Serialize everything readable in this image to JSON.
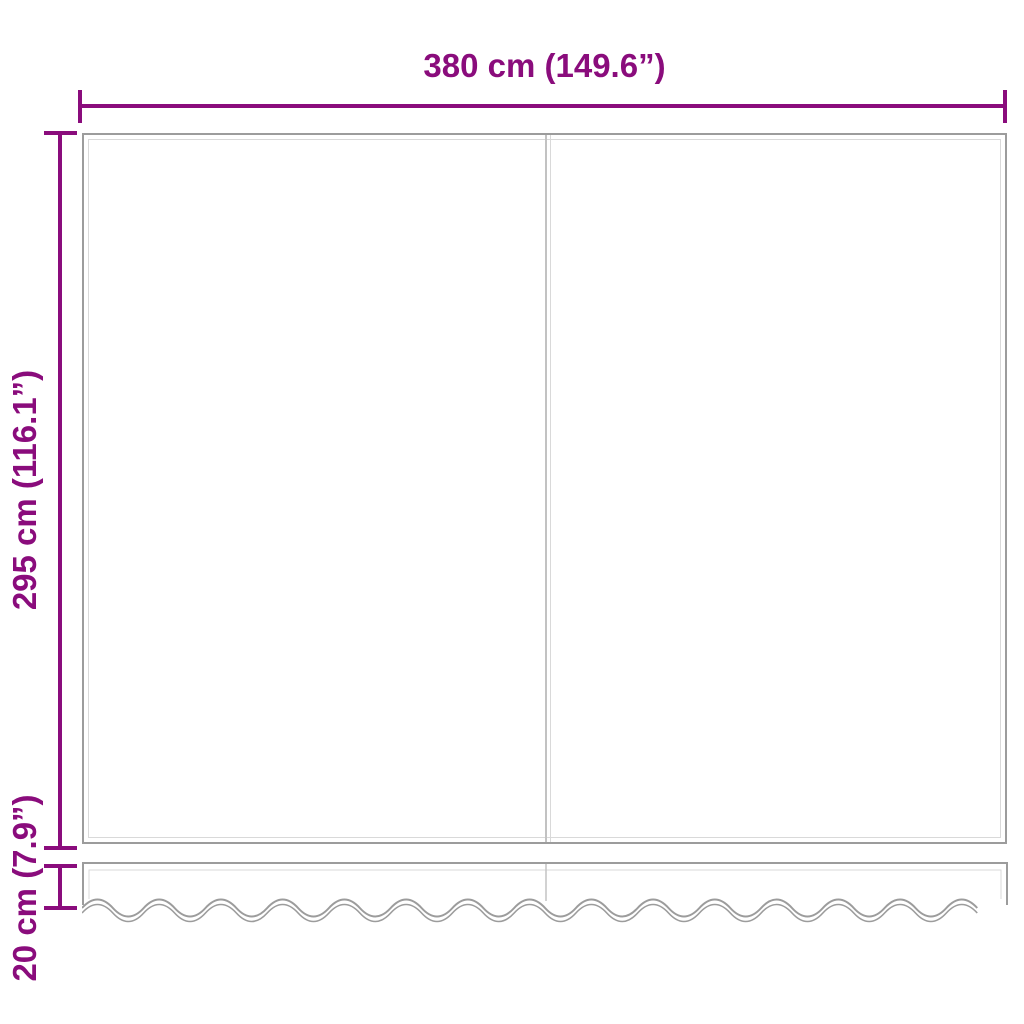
{
  "colors": {
    "dimension": "#8a0c7c",
    "outline": "#9c9c9c",
    "outline-light": "#d9d9d9",
    "seam": "#c2c2c2",
    "bg": "#ffffff"
  },
  "diagram": {
    "description": "awning-replacement-fabric-dimension-diagram",
    "dimensions": {
      "width": {
        "label": "380 cm (149.6”)"
      },
      "height": {
        "label": "295 cm (116.1”)"
      },
      "valance_height": {
        "label": "20 cm (7.9”)"
      }
    }
  }
}
